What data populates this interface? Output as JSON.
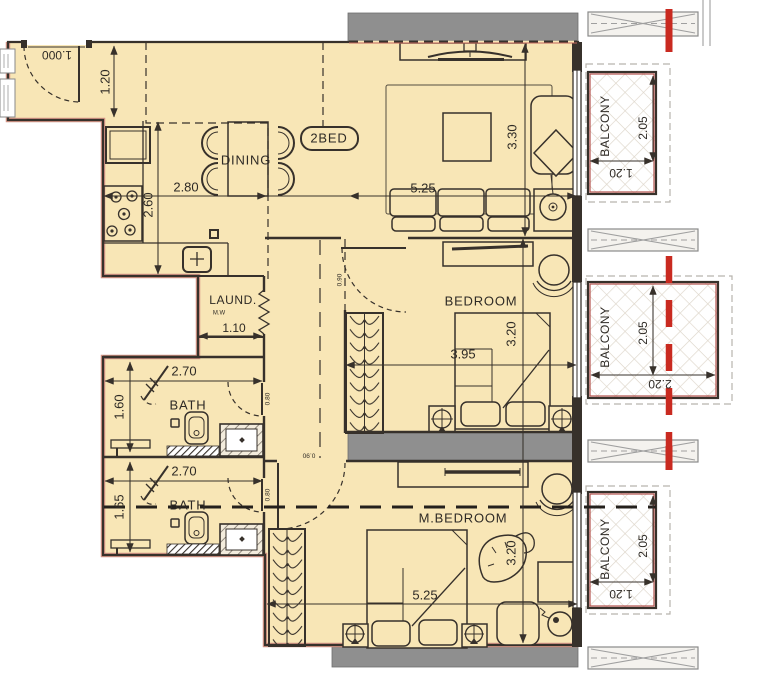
{
  "plan": {
    "unit_badge": "2BED",
    "rooms": {
      "dining": "DINING",
      "bedroom": "BEDROOM",
      "master_bedroom": "M.BEDROOM",
      "bath_1": "BATH",
      "bath_2": "BATH",
      "laundry": "LAUND.",
      "laundry_appliance": "M.W",
      "balcony_1": "BALCONY",
      "balcony_2": "BALCONY",
      "balcony_3": "BALCONY"
    },
    "dimensions": {
      "entry_door": "1.000",
      "entry_depth": "1.20",
      "kitchen_width": "2.80",
      "kitchen_depth": "2.60",
      "living_width": "5.25",
      "living_depth": "3.30",
      "bedroom_width": "3.95",
      "bedroom_depth": "3.20",
      "master_width": "5.25",
      "master_depth": "3.20",
      "laundry_width": "1.10",
      "bath1_width": "2.70",
      "bath1_depth": "1.60",
      "bath2_width": "2.70",
      "bath2_depth": "1.65",
      "balcony1_depth": "2.05",
      "balcony1_width": "1.20",
      "balcony2_depth": "2.05",
      "balcony2_width": "2.20",
      "balcony3_depth": "2.05",
      "balcony3_width": "1.20",
      "bedroom_door": "0.90",
      "master_door": "0.90",
      "bath1_door": "0.80",
      "bath2_door": "0.80"
    },
    "colors": {
      "floor": "#f8e6b6",
      "wall": "#37312b",
      "gray": "#8f8f8f",
      "red": "#c92a20",
      "pink": "#d59586",
      "text": "#2e2a25",
      "balcony-red": "#b5524c",
      "lattice": "#ddd5c9"
    }
  }
}
